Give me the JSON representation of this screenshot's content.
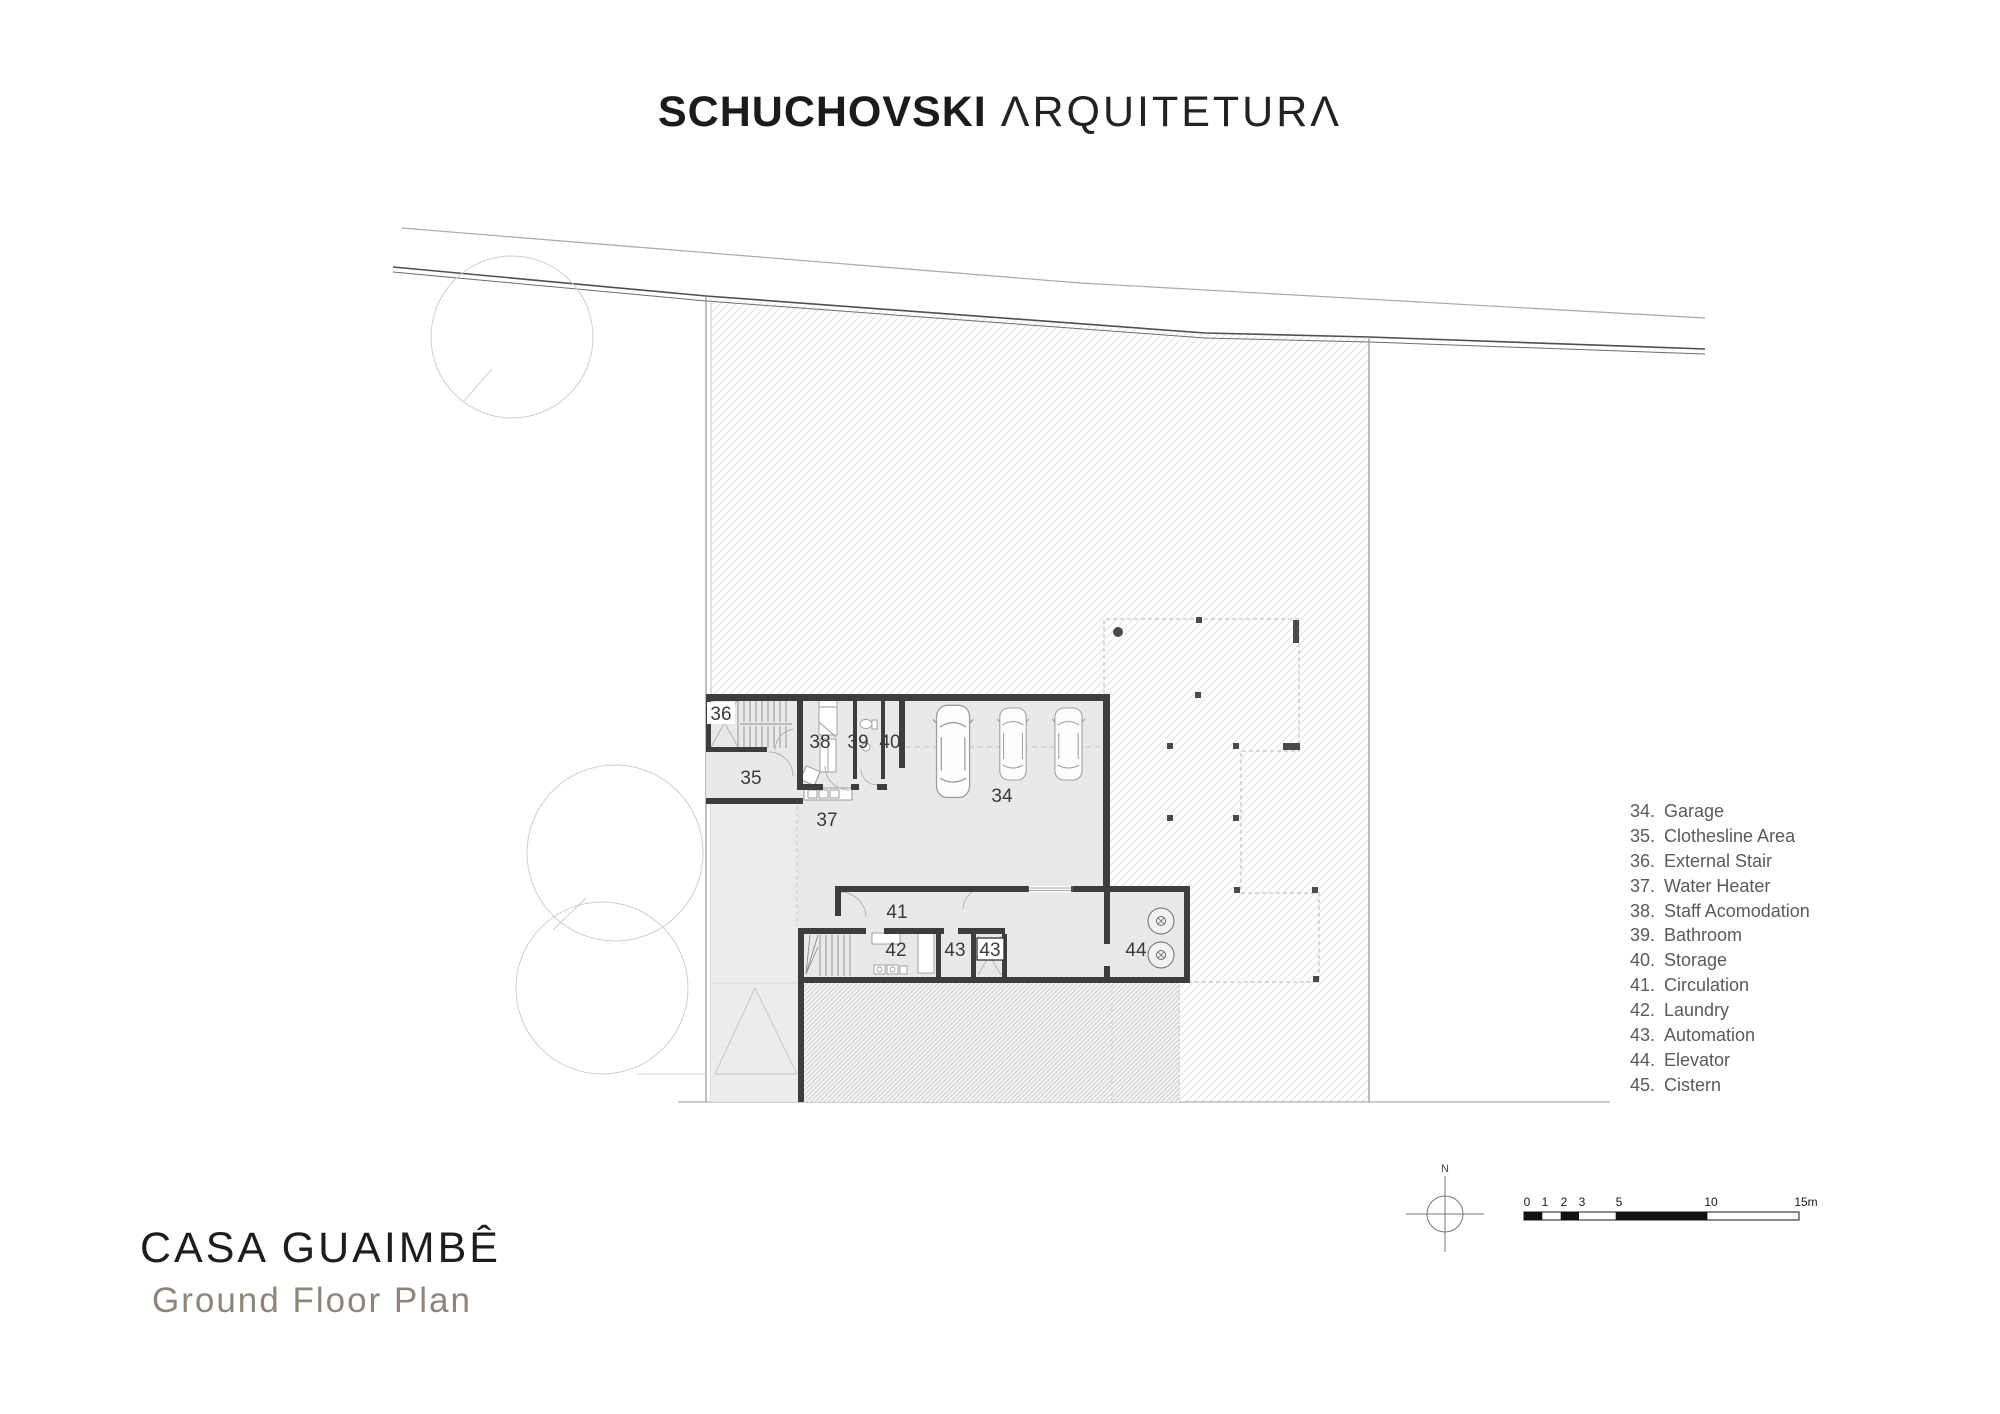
{
  "logo": {
    "part1": "SCHUCHOVSKI",
    "part2": "ΛRQUITETURΛ"
  },
  "title_block": {
    "title": "CASA GUAIMBÊ",
    "subtitle": "Ground Floor Plan"
  },
  "legend": {
    "items": [
      {
        "num": "34.",
        "label": "Garage"
      },
      {
        "num": "35.",
        "label": "Clothesline Area"
      },
      {
        "num": "36.",
        "label": "External Stair"
      },
      {
        "num": "37.",
        "label": "Water Heater"
      },
      {
        "num": "38.",
        "label": "Staff Acomodation"
      },
      {
        "num": "39.",
        "label": "Bathroom"
      },
      {
        "num": "40.",
        "label": "Storage"
      },
      {
        "num": "41.",
        "label": "Circulation"
      },
      {
        "num": "42.",
        "label": "Laundry"
      },
      {
        "num": "43.",
        "label": "Automation"
      },
      {
        "num": "44.",
        "label": "Elevator"
      },
      {
        "num": "45.",
        "label": "Cistern"
      }
    ]
  },
  "plan": {
    "room_labels": [
      "34",
      "35",
      "36",
      "37",
      "38",
      "39",
      "40",
      "41",
      "42",
      "43",
      "43",
      "44"
    ]
  },
  "north": {
    "label": "N"
  },
  "scale_bar": {
    "labels": [
      "0",
      "1",
      "2",
      "3",
      "5",
      "10",
      "15m"
    ]
  },
  "colors": {
    "wall": "#3d3d3d",
    "room_fill": "#e9e9e9",
    "hatch_line": "#dedede",
    "boundary": "#5a5a5a",
    "title": "#1d1d1b",
    "subtitle": "#8b857c",
    "legend_text": "#5a5a5a"
  }
}
